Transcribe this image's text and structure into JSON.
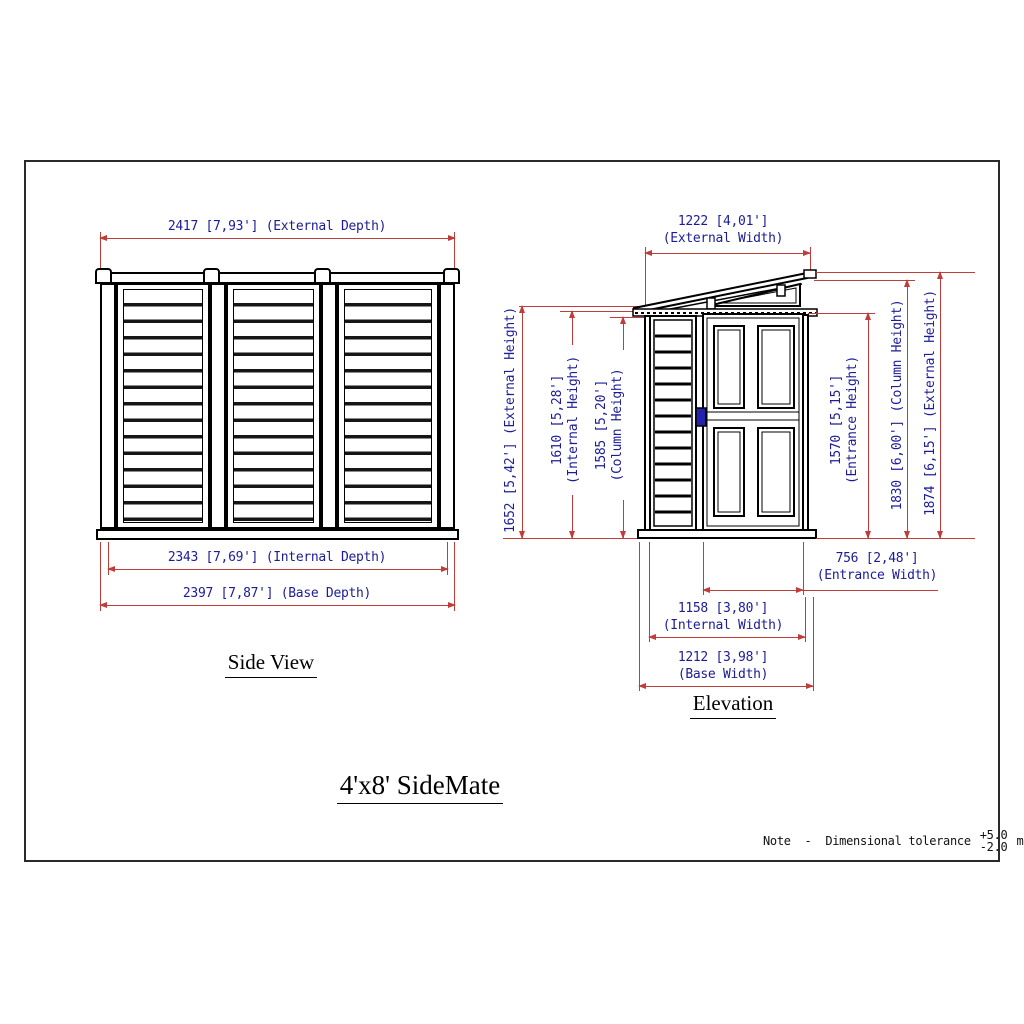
{
  "title": "4'x8' SideMate",
  "side_view": {
    "caption": "Side View",
    "external_depth": "2417 [7,93'] (External Depth)",
    "internal_depth": "2343 [7,69'] (Internal Depth)",
    "base_depth": "2397 [7,87'] (Base Depth)"
  },
  "elevation": {
    "caption": "Elevation",
    "external_width_value": "1222 [4,01']",
    "external_width_label": "(External Width)",
    "external_height_left": "1652 [5,42'] (External Height)",
    "internal_height_value": "1610 [5,28']",
    "internal_height_label": "(Internal Height)",
    "column_height_left_value": "1585 [5,20']",
    "column_height_left_label": "(Column Height)",
    "entrance_height_value": "1570 [5,15']",
    "entrance_height_label": "(Entrance Height)",
    "column_height_right": "1830 [6,00'] (Column Height)",
    "external_height_right": "1874 [6,15'] (External Height)",
    "entrance_width_value": "756 [2,48']",
    "entrance_width_label": "(Entrance Width)",
    "internal_width_value": "1158 [3,80']",
    "internal_width_label": "(Internal Width)",
    "base_width_value": "1212 [3,98']",
    "base_width_label": "(Base Width)"
  },
  "note": {
    "label": "Note  -  Dimensional tolerance",
    "tolerance_plus": "+5.0",
    "tolerance_minus": "-2.0",
    "unit": "mm."
  },
  "colors": {
    "dimension_line": "#bf3d3a",
    "dimension_text": "#1c1c96",
    "drawing_line": "#000000",
    "handle": "#2222aa"
  }
}
